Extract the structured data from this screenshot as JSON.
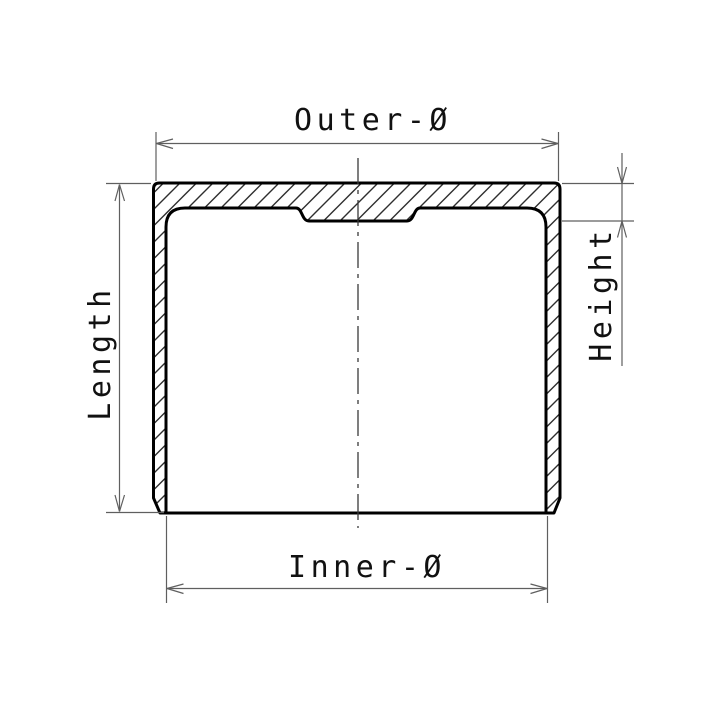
{
  "figure": {
    "type": "cross-section technical drawing of cup-shaped part (valve tappet)",
    "labels": {
      "outer_diameter": "Outer-Ø",
      "inner_diameter": "Inner-Ø",
      "length": "Length",
      "height": "Height"
    }
  },
  "colors": {
    "background": "#ffffff",
    "part_outline": "#000000",
    "hatch": "#2e2e2e",
    "dimension_lines": "#5f5f5f",
    "centerline": "#3a3a3a",
    "text": "#111111"
  }
}
